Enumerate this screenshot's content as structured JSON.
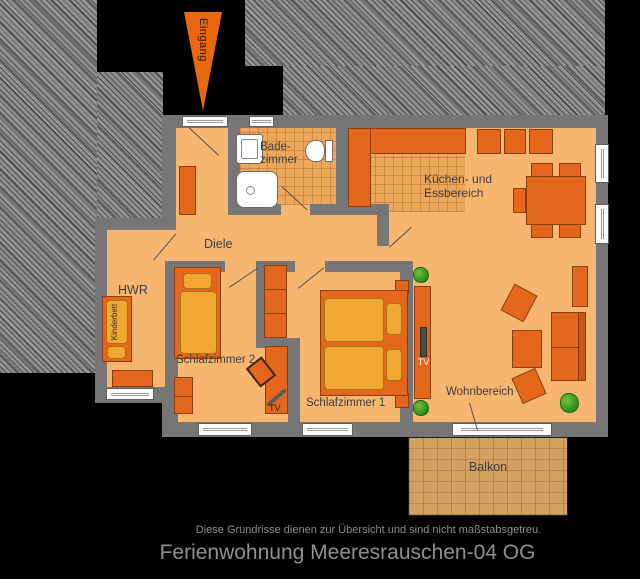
{
  "title": "Ferienwohnung Meeresrauschen-04 OG",
  "disclaimer": "Diese Grundrisse dienen zur Übersicht und sind nicht maßstabsgetreu.",
  "entrance": {
    "label": "Eingang"
  },
  "rooms": {
    "diele": {
      "label": "Diele"
    },
    "hwr": {
      "label": "HWR"
    },
    "bad": {
      "line1": "Bade-",
      "line2": "zimmer"
    },
    "kueche": {
      "line1": "Küchen- und",
      "line2": "Essbereich"
    },
    "schlafzimmer2": {
      "label": "Schlafzimmer 2"
    },
    "schlafzimmer1": {
      "label": "Schlafzimmer 1"
    },
    "wohnbereich": {
      "label": "Wohnbereich"
    },
    "balkon": {
      "label": "Balkon"
    }
  },
  "furniture": {
    "kinderbett": "Kinderbett",
    "tv_living": "TV",
    "tv_bedroom2": "TV"
  },
  "icons": {
    "entrance_arrow": "down-arrow-icon",
    "plants": "plant-icon"
  },
  "colors": {
    "background": "#000000",
    "hatch_gray": "#8f8f8f",
    "wall": "#767676",
    "floor": "#f6b670",
    "furniture": "#e5671d",
    "mattress": "#f0a832",
    "balcony": "#d3a260",
    "plant": "#3fa32e",
    "accent_arrow": "#e8680f"
  }
}
